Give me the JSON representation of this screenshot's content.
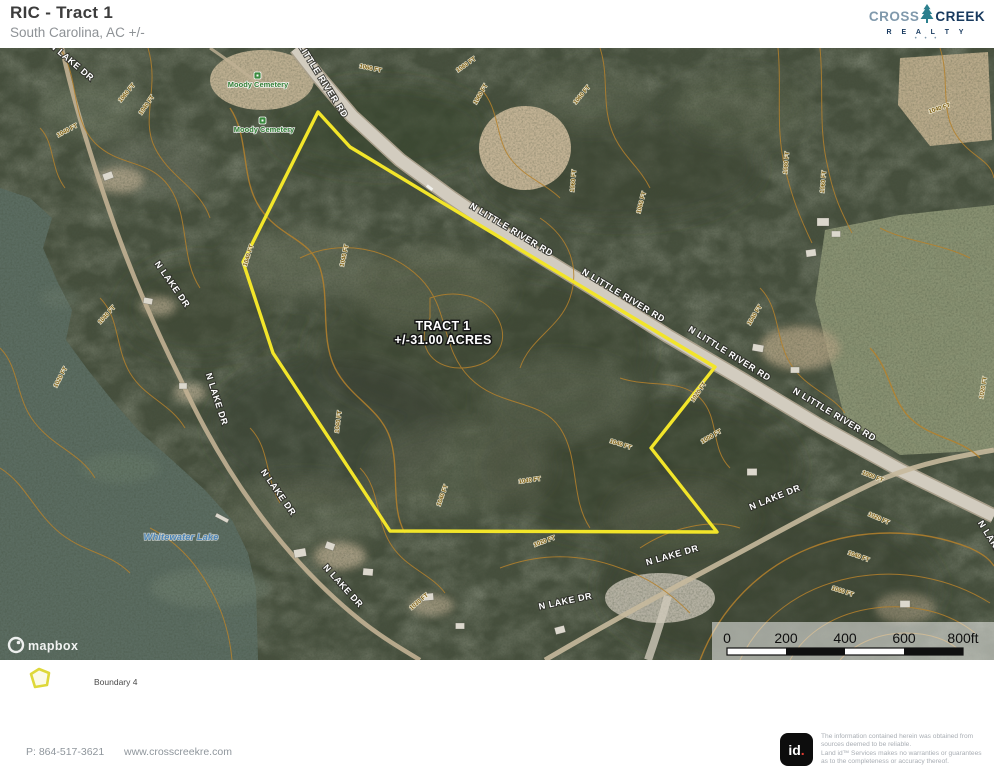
{
  "header": {
    "title": "RIC - Tract 1",
    "subtitle": "South Carolina,  AC +/-"
  },
  "logo": {
    "cross": "CROSS",
    "creek": "CREEK",
    "realty": "R E A L T Y",
    "dots": "• • •",
    "tree_icon_color": "#2c7f8e"
  },
  "map": {
    "tract_label": {
      "line1": "TRACT 1",
      "line2": "+/-31.00 ACRES"
    },
    "boundary_points": "318,64 350,99 715,319 651,400 717,484 390,483 273,305 243,214",
    "boundary_color": "#f2e52a",
    "road_labels": [
      {
        "text": "N LITTLE RIVER RD",
        "x": 318,
        "y": 30,
        "rot": 58
      },
      {
        "text": "N LITTLE RIVER RD",
        "x": 510,
        "y": 184,
        "rot": 31
      },
      {
        "text": "N LITTLE RIVER RD",
        "x": 622,
        "y": 250,
        "rot": 31
      },
      {
        "text": "N LITTLE RIVER RD",
        "x": 728,
        "y": 308,
        "rot": 32
      },
      {
        "text": "N LITTLE RIVER RD",
        "x": 833,
        "y": 369,
        "rot": 31
      },
      {
        "text": "N LAKE DR",
        "x": 70,
        "y": 16,
        "rot": 40
      },
      {
        "text": "N LAKE DR",
        "x": 170,
        "y": 238,
        "rot": 55
      },
      {
        "text": "N LAKE DR",
        "x": 214,
        "y": 352,
        "rot": 72
      },
      {
        "text": "N LAKE DR",
        "x": 276,
        "y": 446,
        "rot": 55
      },
      {
        "text": "N LAKE DR",
        "x": 341,
        "y": 540,
        "rot": 48
      },
      {
        "text": "N LAKE DR",
        "x": 566,
        "y": 556,
        "rot": -12
      },
      {
        "text": "N LAKE DR",
        "x": 673,
        "y": 510,
        "rot": -16
      },
      {
        "text": "N LAKE DR",
        "x": 776,
        "y": 452,
        "rot": -22
      },
      {
        "text": "N LAKE DR",
        "x": 992,
        "y": 498,
        "rot": 58
      }
    ],
    "place_labels": [
      {
        "text": "Moody Cemetery",
        "x": 258,
        "y": 39,
        "kind": "cemetery"
      },
      {
        "text": "Moody Cemetery",
        "x": 264,
        "y": 84,
        "kind": "cemetery"
      },
      {
        "text": "Whitewater Lake",
        "x": 181,
        "y": 492,
        "kind": "water"
      }
    ],
    "contour_labels": [
      {
        "text": "1060 FT",
        "x": 467,
        "y": 18,
        "rot": -35
      },
      {
        "text": "1060 FT",
        "x": 482,
        "y": 47,
        "rot": -60
      },
      {
        "text": "1060 FT",
        "x": 583,
        "y": 48,
        "rot": -50
      },
      {
        "text": "1060 FT",
        "x": 575,
        "y": 133,
        "rot": -85
      },
      {
        "text": "1060 FT",
        "x": 643,
        "y": 155,
        "rot": -75
      },
      {
        "text": "1060 FT",
        "x": 370,
        "y": 22,
        "rot": 12
      },
      {
        "text": "1040 FT",
        "x": 148,
        "y": 58,
        "rot": -55
      },
      {
        "text": "1040 FT",
        "x": 68,
        "y": 84,
        "rot": -28
      },
      {
        "text": "1060 FT",
        "x": 128,
        "y": 46,
        "rot": -50
      },
      {
        "text": "1040 FT",
        "x": 250,
        "y": 208,
        "rot": -72
      },
      {
        "text": "1040 FT",
        "x": 346,
        "y": 208,
        "rot": -78
      },
      {
        "text": "1040 FT",
        "x": 108,
        "y": 268,
        "rot": -48
      },
      {
        "text": "1020 FT",
        "x": 62,
        "y": 330,
        "rot": -62
      },
      {
        "text": "1040 FT",
        "x": 340,
        "y": 374,
        "rot": -82
      },
      {
        "text": "1040 FT",
        "x": 444,
        "y": 448,
        "rot": -70
      },
      {
        "text": "1040 FT",
        "x": 530,
        "y": 434,
        "rot": -8
      },
      {
        "text": "1040 FT",
        "x": 620,
        "y": 398,
        "rot": 18
      },
      {
        "text": "1040 FT",
        "x": 756,
        "y": 268,
        "rot": -58
      },
      {
        "text": "1080 FT",
        "x": 788,
        "y": 115,
        "rot": -85
      },
      {
        "text": "1060 FT",
        "x": 825,
        "y": 134,
        "rot": -85
      },
      {
        "text": "1040 FT",
        "x": 940,
        "y": 62,
        "rot": -18
      },
      {
        "text": "1000 FT",
        "x": 872,
        "y": 430,
        "rot": 22
      },
      {
        "text": "1020 FT",
        "x": 878,
        "y": 472,
        "rot": 24
      },
      {
        "text": "1040 FT",
        "x": 858,
        "y": 510,
        "rot": 20
      },
      {
        "text": "1060 FT",
        "x": 842,
        "y": 545,
        "rot": 18
      },
      {
        "text": "1020 FT",
        "x": 985,
        "y": 340,
        "rot": -80
      },
      {
        "text": "1000 FT",
        "x": 712,
        "y": 390,
        "rot": -30
      },
      {
        "text": "1020 FT",
        "x": 700,
        "y": 345,
        "rot": -55
      },
      {
        "text": "1030 FT",
        "x": 420,
        "y": 555,
        "rot": -40
      },
      {
        "text": "1020 FT",
        "x": 545,
        "y": 495,
        "rot": -20
      }
    ],
    "scale_bar": {
      "ticks": [
        "0",
        "200",
        "400",
        "600",
        "800ft"
      ]
    },
    "attribution": "mapbox"
  },
  "legend": {
    "items": [
      {
        "label": "Boundary 4",
        "color": "#ded83a"
      }
    ]
  },
  "footer": {
    "phone": "P: 864-517-3621",
    "website": "www.crosscreekre.com",
    "id_text": "id",
    "id_dot": ".",
    "disclaimer_lines": [
      "The information contained herein was obtained from",
      "sources deemed to be reliable.",
      "Land id™ Services makes no warranties or guarantees",
      "as to the completeness or accuracy thereof."
    ]
  }
}
